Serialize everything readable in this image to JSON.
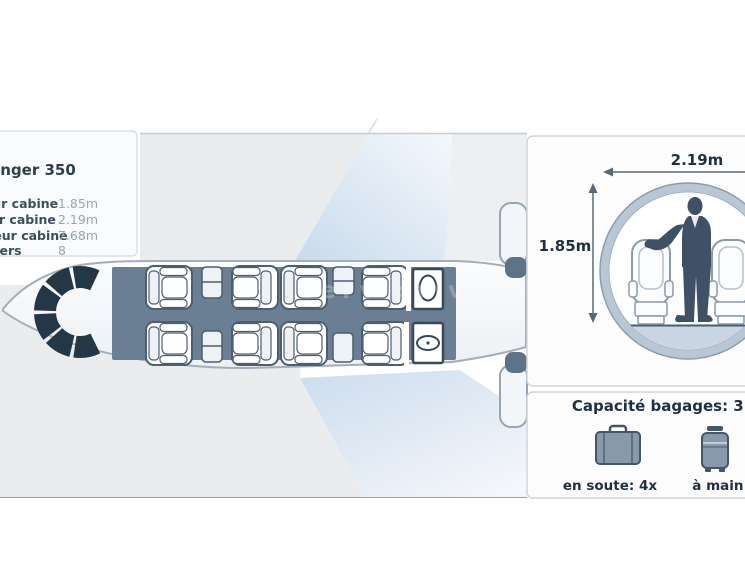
{
  "info_panel": {
    "title": "Challenger 350",
    "specs": [
      {
        "label": "Hauteur cabine",
        "value": "1.85m"
      },
      {
        "label": "Largeur cabine",
        "value": "2.19m"
      },
      {
        "label": "Longueur cabine",
        "value": "7.68m"
      },
      {
        "label": "Passagers",
        "value": "8"
      }
    ]
  },
  "cross_section": {
    "width_label": "2.19m",
    "height_label": "1.85m"
  },
  "baggage": {
    "title": "Capacité bagages: 3.0m³",
    "hold_label": "en soute: 4x",
    "hand_label": "à main: 4x"
  },
  "watermark": "serv priv",
  "colors": {
    "cabin_floor": "#6a7f93",
    "cockpit": "#243747",
    "text_dark": "#1f3040",
    "ring": "#b9c7d5",
    "silhouette": "#3f5166",
    "wing_blue": "#c9daec",
    "panel_border": "#cfd5da",
    "slab_gray": "#e9ebec"
  }
}
